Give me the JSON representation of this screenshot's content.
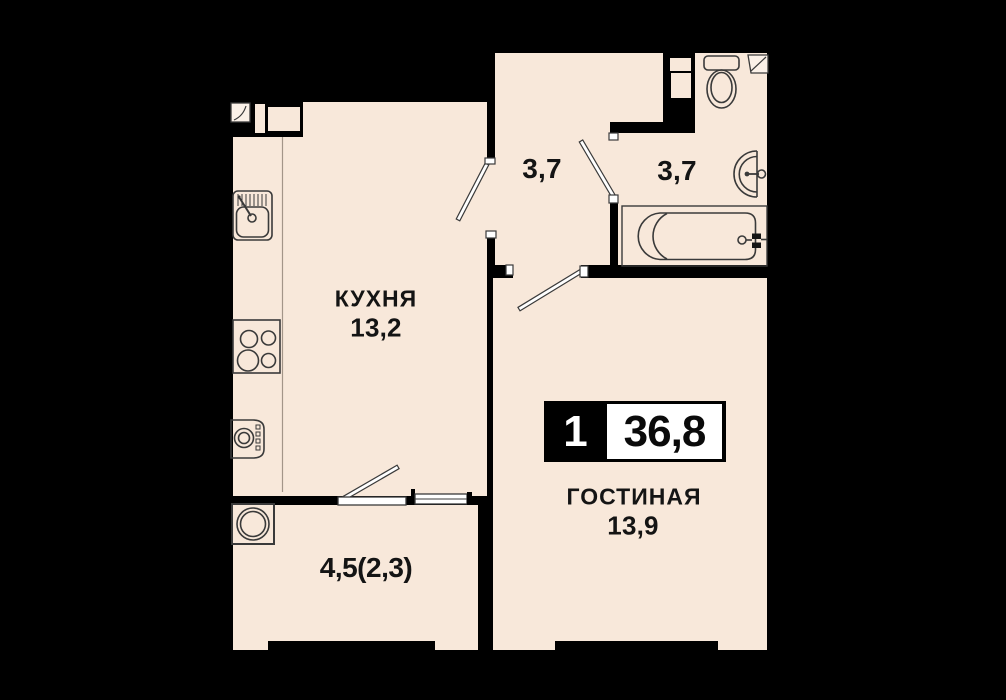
{
  "title": "Apartment floor plan 1-room 36,8",
  "badge": {
    "room_count": "1",
    "total_area": "36,8"
  },
  "rooms": {
    "kitchen": {
      "name": "КУХНЯ",
      "area": "13,2"
    },
    "hallway": {
      "area": "3,7"
    },
    "bathroom": {
      "area": "3,7"
    },
    "living": {
      "name": "ГОСТИНАЯ",
      "area": "13,9"
    },
    "balcony": {
      "area": "4,5(2,3)"
    }
  },
  "colors": {
    "background": "#000000",
    "floor": "#f8e8da",
    "outline": "#3a3a3a",
    "text": "#141414",
    "badge_bg": "#000000",
    "badge_area_bg": "#ffffff"
  }
}
